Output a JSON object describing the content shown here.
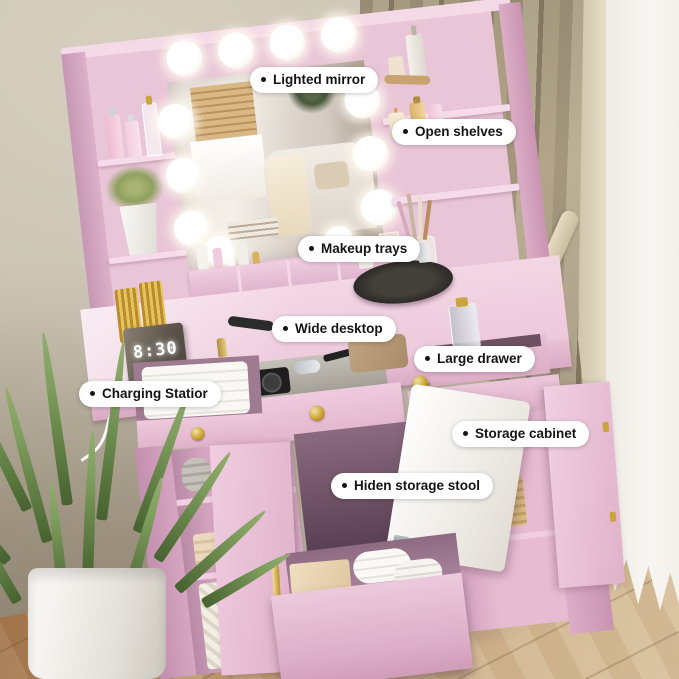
{
  "labels": [
    {
      "id": "lighted-mirror",
      "text": "Lighted mirror"
    },
    {
      "id": "open-shelves",
      "text": "Open shelves"
    },
    {
      "id": "makeup-trays",
      "text": "Makeup trays"
    },
    {
      "id": "wide-desktop",
      "text": "Wide desktop"
    },
    {
      "id": "large-drawer",
      "text": "Large drawer"
    },
    {
      "id": "charging-station",
      "text": "Charging Statior"
    },
    {
      "id": "storage-cabinet",
      "text": "Storage cabinet"
    },
    {
      "id": "hidden-storage-stool",
      "text": "Hiden storage stool"
    }
  ],
  "clock": {
    "time": "8:30"
  },
  "book": {
    "spine_text": "MORE LIFE"
  },
  "colors": {
    "pink": "#e9c6d7",
    "pink_light": "#f3d6e4",
    "pink_dark": "#d9a9c4",
    "gold": "#c9a227",
    "curtain": "#a4977e",
    "wall": "#ccc5b5",
    "floor": "#b98e63",
    "white": "#ffffff",
    "labelbg": "#ffffff",
    "ink": "#141414"
  }
}
